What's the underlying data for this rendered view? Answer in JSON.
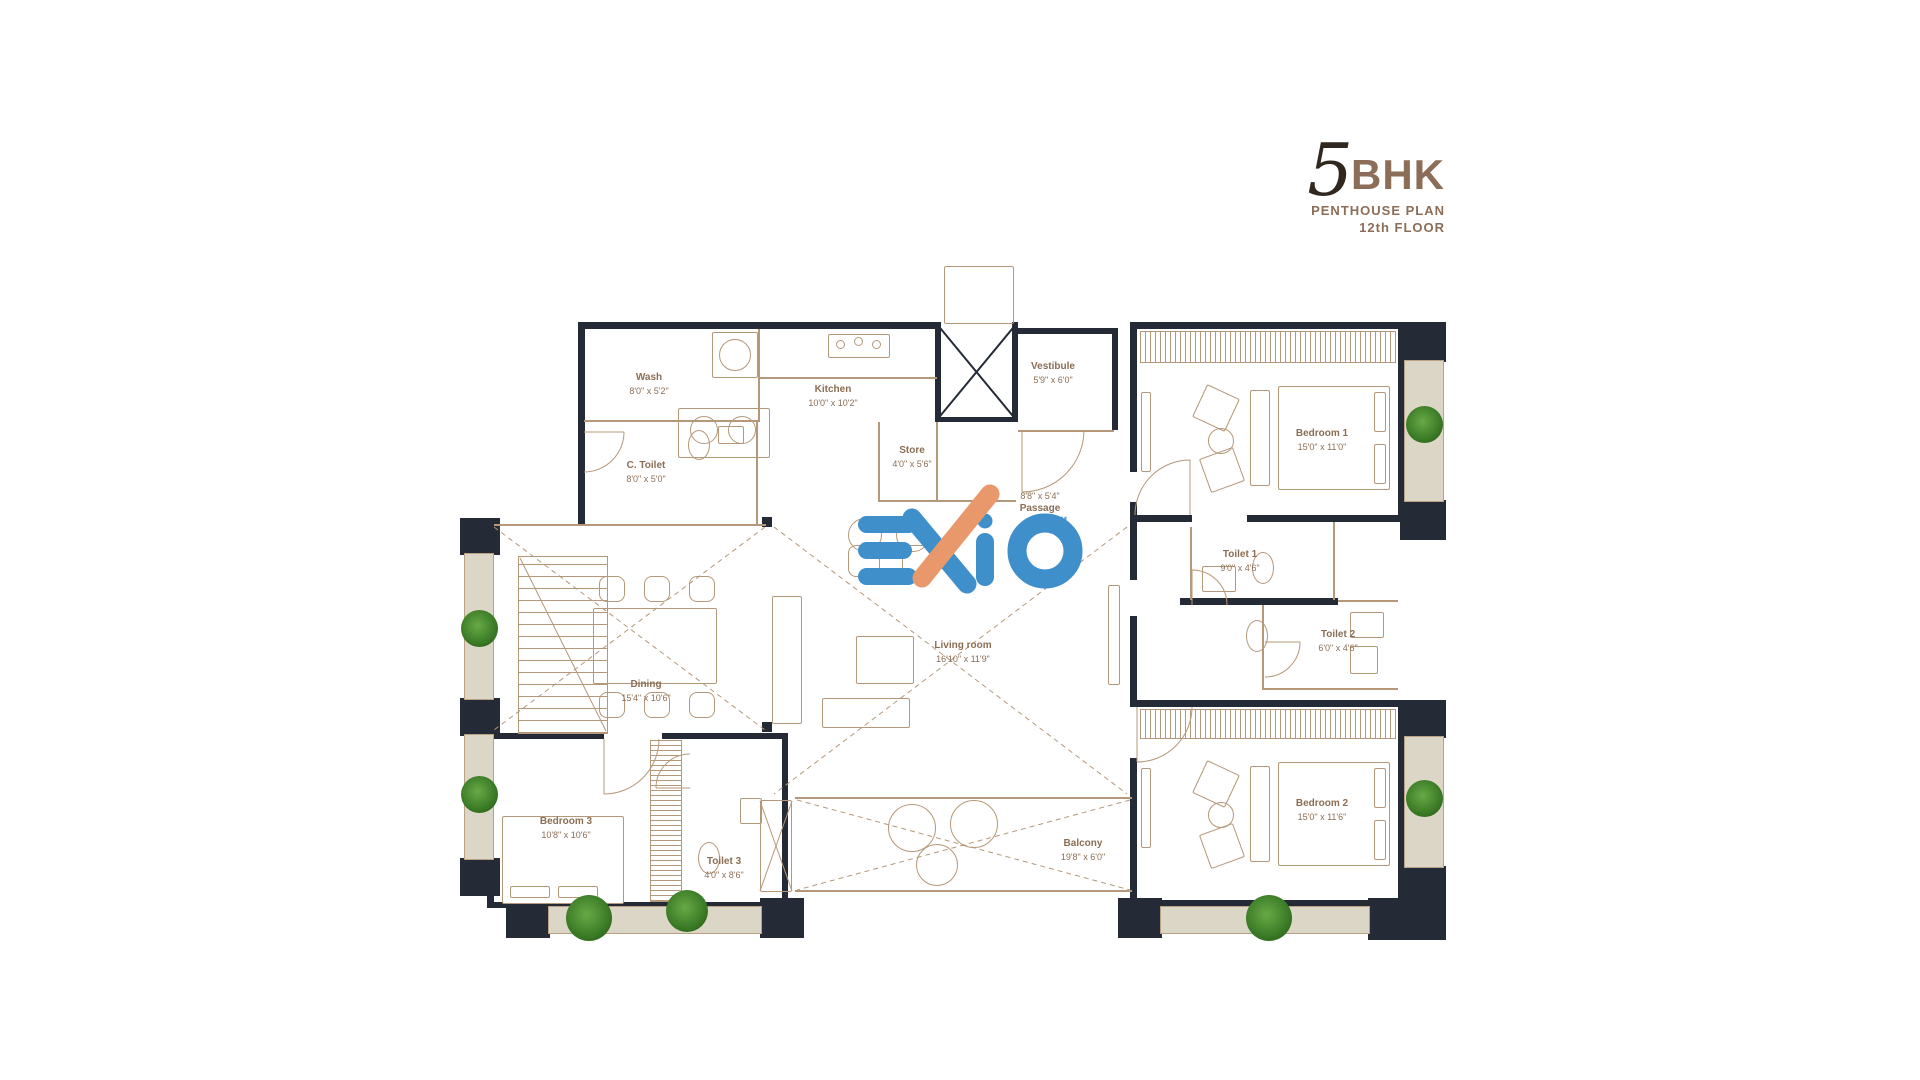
{
  "title": {
    "number": "5",
    "suffix": "BHK",
    "line1": "PENTHOUSE PLAN",
    "line2": "12th FLOOR"
  },
  "logo": {
    "brand": "EXIO",
    "tm": "™",
    "blue": "#3E8FCA",
    "orange": "#E8986B"
  },
  "rooms": [
    {
      "name": "Wash",
      "dims": "8'0\" x 5'2\""
    },
    {
      "name": "Kitchen",
      "dims": "10'0\" x 10'2\""
    },
    {
      "name": "Store",
      "dims": "4'0\" x 5'6\""
    },
    {
      "name": "Vestibule",
      "dims": "5'9\" x 6'0\""
    },
    {
      "name": "C. Toilet",
      "dims": "8'0\" x 5'0\""
    },
    {
      "name": "Bedroom 1",
      "dims": "15'0\" x 11'0\""
    },
    {
      "name": "Passage",
      "dims": "8'8\" x 5'4\""
    },
    {
      "name": "Toilet 1",
      "dims": "9'0\" x 4'6\""
    },
    {
      "name": "Toilet 2",
      "dims": "6'0\" x 4'6\""
    },
    {
      "name": "Dining",
      "dims": "15'4\" x 10'6\""
    },
    {
      "name": "Living room",
      "dims": "16'10\" x 11'9\""
    },
    {
      "name": "Bedroom 3",
      "dims": "10'8\" x 10'6\""
    },
    {
      "name": "Toilet 3",
      "dims": "4'0\" x 8'6\""
    },
    {
      "name": "Balcony",
      "dims": "19'8\" x 6'0\""
    },
    {
      "name": "Bedroom 2",
      "dims": "15'0\" x 11'6\""
    }
  ]
}
